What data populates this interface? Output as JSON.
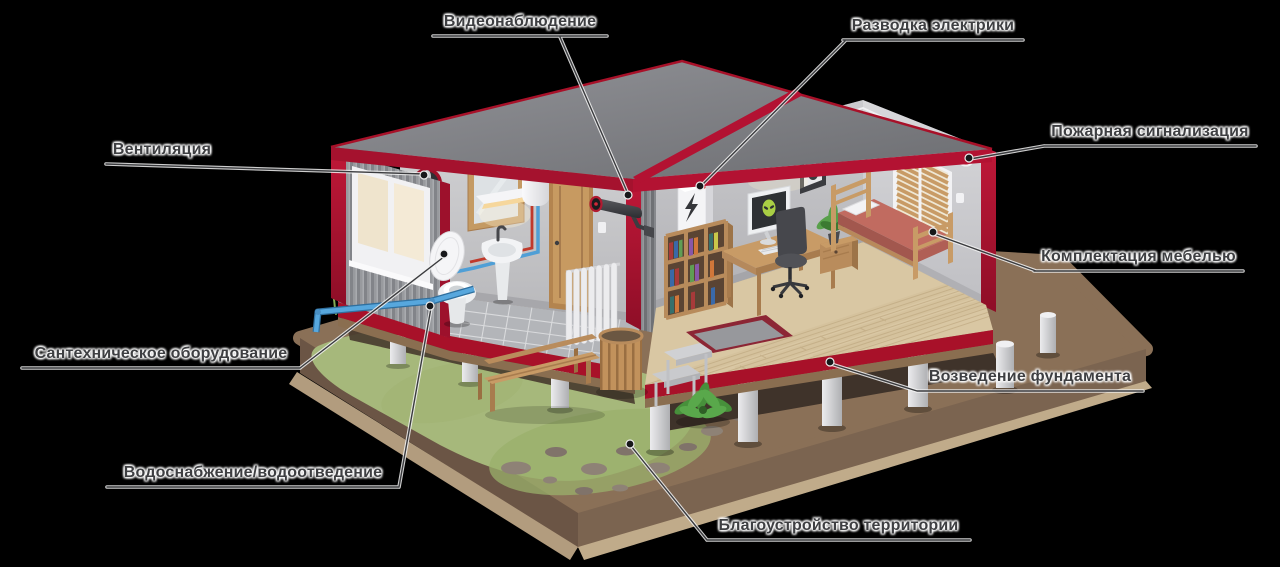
{
  "background": "#000000",
  "colors": {
    "accent_red": "#b31232",
    "roof_gray": "#7e7f84",
    "ground_brown": "#8a7057",
    "grass_green": "#a6b87b"
  },
  "labels": [
    {
      "id": "video-surveillance",
      "text": "Видеонаблюдение"
    },
    {
      "id": "electrical-wiring",
      "text": "Разводка электрики"
    },
    {
      "id": "ventilation",
      "text": "Вентиляция"
    },
    {
      "id": "fire-alarm",
      "text": "Пожарная сигнализация"
    },
    {
      "id": "furniture",
      "text": "Комплектация мебелью"
    },
    {
      "id": "plumbing",
      "text": "Сантехническое оборудование"
    },
    {
      "id": "foundation",
      "text": "Возведение фундамента"
    },
    {
      "id": "water-supply",
      "text": "Водоснабжение/водоотведение"
    },
    {
      "id": "landscaping",
      "text": "Благоустройство территории"
    }
  ]
}
